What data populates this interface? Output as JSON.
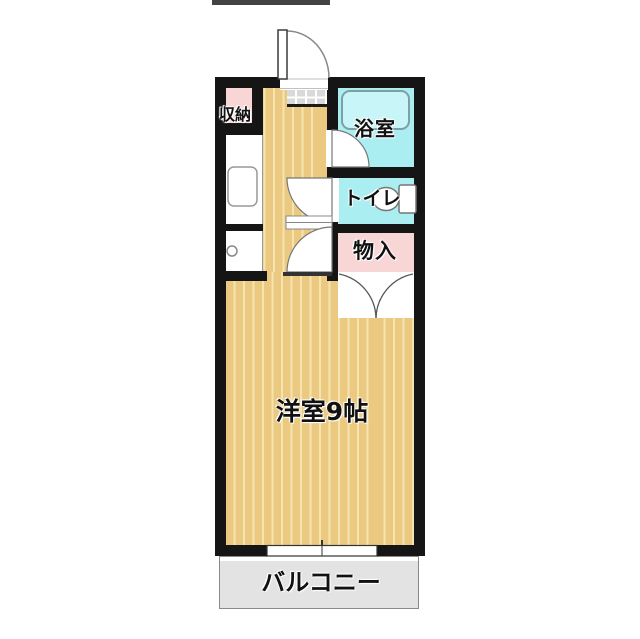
{
  "labels": {
    "storage": "収納",
    "bathroom": "浴室",
    "toilet": "トイレ",
    "closet": "物入",
    "main_room": "洋室9帖",
    "balcony": "バルコニー"
  },
  "colors": {
    "wall": "#151515",
    "floor_base": "#ebc981",
    "floor_stripe": "#f6e4ae",
    "wet_area_cyan": "#abeef2",
    "closet_pink": "#f8d6d6",
    "balcony_gray": "#e3e3e3",
    "genkan_tile": "#d9d9d9"
  }
}
